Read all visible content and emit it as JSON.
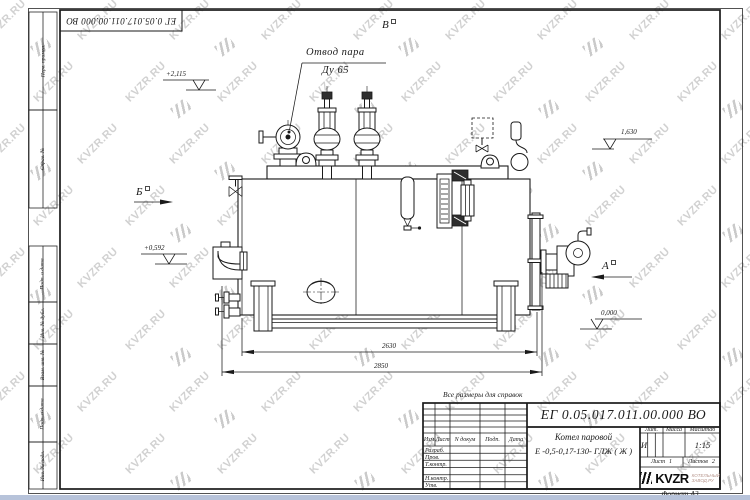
{
  "sheet": {
    "note": "Все размеры для справок",
    "format": "Формат А3",
    "doc_number": "ЕГ 0.05.017.011.00.000  ВО"
  },
  "title_block": {
    "doc_number": "ЕГ 0.05.017.011.00.000  ВО",
    "product_name": "Котел паровой",
    "product_code": "Е -0,5-0,17-130- ГЛЖ ( Ж )",
    "columns": {
      "izm": "Изм",
      "list": "Лист",
      "ndokum": "N докум",
      "podp": "Подп.",
      "data": "Дата"
    },
    "sign_rows": [
      "Разраб.",
      "Пров.",
      "Т.контр.",
      "",
      "Н.контр.",
      "Утв."
    ],
    "lit_label": "Лит.",
    "lit_value": "И",
    "mass_label": "Масса",
    "scale_label": "Масштаб",
    "scale_value": "1:15",
    "sheet_label": "Лист",
    "sheet_value": "1",
    "sheets_label": "Листов",
    "sheets_value": "2",
    "brand": "KVZR",
    "brand_line1": "КОТЕЛЬНЫЙ",
    "brand_line2": "ЗАВОД.РУ"
  },
  "margins": {
    "labels": [
      "Перв. примен.",
      "Справ. №",
      "Подп. и дата",
      "Инв. № дубл.",
      "Взам. инв. №",
      "Подп. и дата",
      "Инв. № подл."
    ]
  },
  "annotations": {
    "callout_line1": "Отвод пара",
    "callout_line2": "Ду 65",
    "view_b": "Б",
    "view_v": "В",
    "view_a": "А",
    "elev_top": "+2,115",
    "elev_right": "1,630",
    "elev_burner": "+0,592",
    "elev_zero": "0,000",
    "dim_inner": "2630",
    "dim_outer": "2850"
  },
  "watermark": {
    "text": "KVZR.RU"
  }
}
